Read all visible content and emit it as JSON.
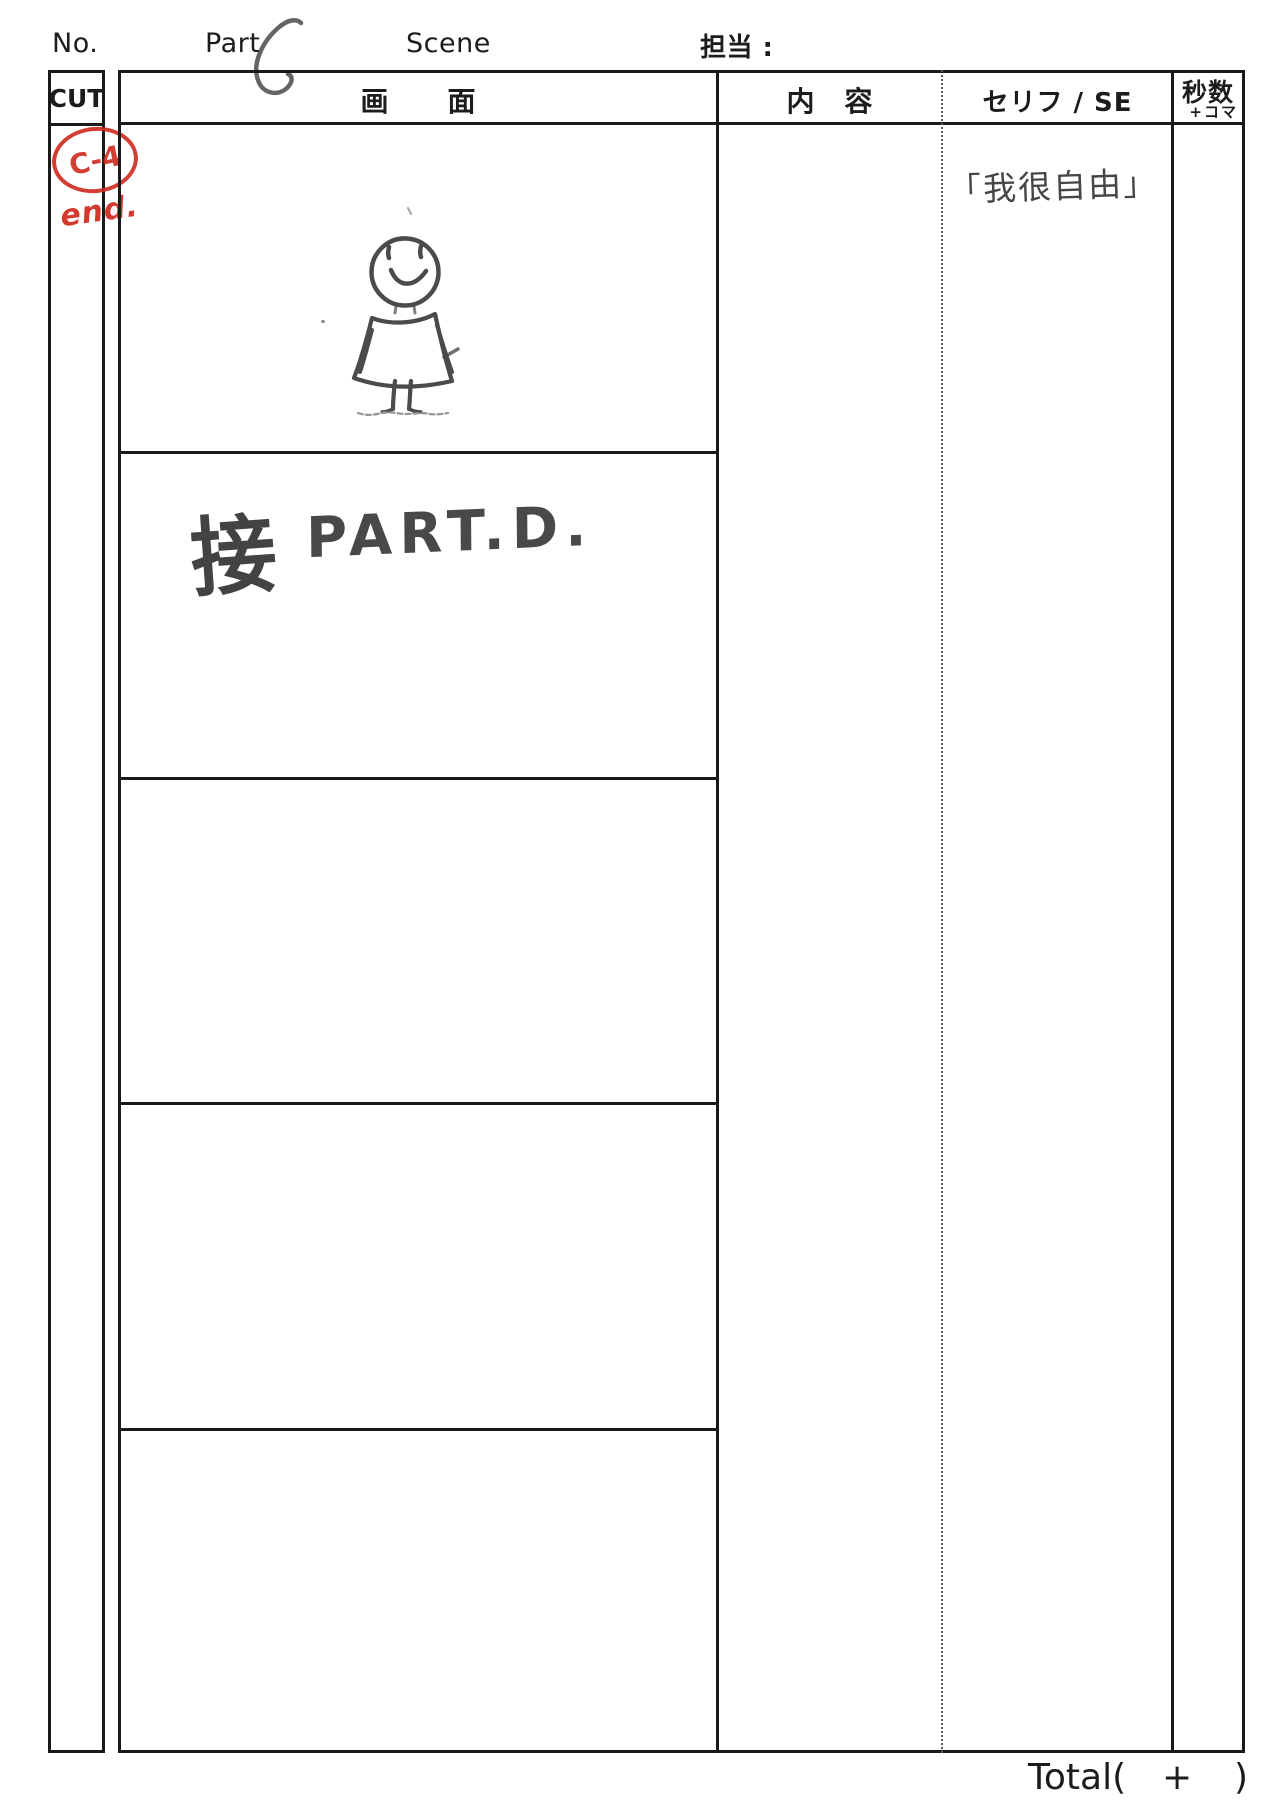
{
  "header": {
    "no_label": "No.",
    "part_label": "Part",
    "part_value": "C",
    "scene_label": "Scene",
    "assignee_label": "担当 :"
  },
  "table": {
    "cut_column_header": "CUT",
    "screen_column_header": "画　　面",
    "content_column_header": "内　容",
    "dialogue_column_header": "セリフ / SE",
    "seconds_column_header": "秒数",
    "seconds_column_subheader": "+コマ"
  },
  "handwritten": {
    "cut_number": "C-4",
    "end_note": "end.",
    "link_kanji": "接",
    "link_target": "PART.D.",
    "dialogue_line": "「我很自由」"
  },
  "footer": {
    "total_label": "Total(",
    "plus_sign": "+",
    "close_paren": ")"
  },
  "colors": {
    "ink_black": "#1a1a1a",
    "pencil_gray": "#3a3a3a",
    "marker_red": "#cf2a1f"
  },
  "icons": {
    "stick_figure": "smiling-stick-figure-sketch",
    "part_letter": "handwritten-letter-c"
  }
}
